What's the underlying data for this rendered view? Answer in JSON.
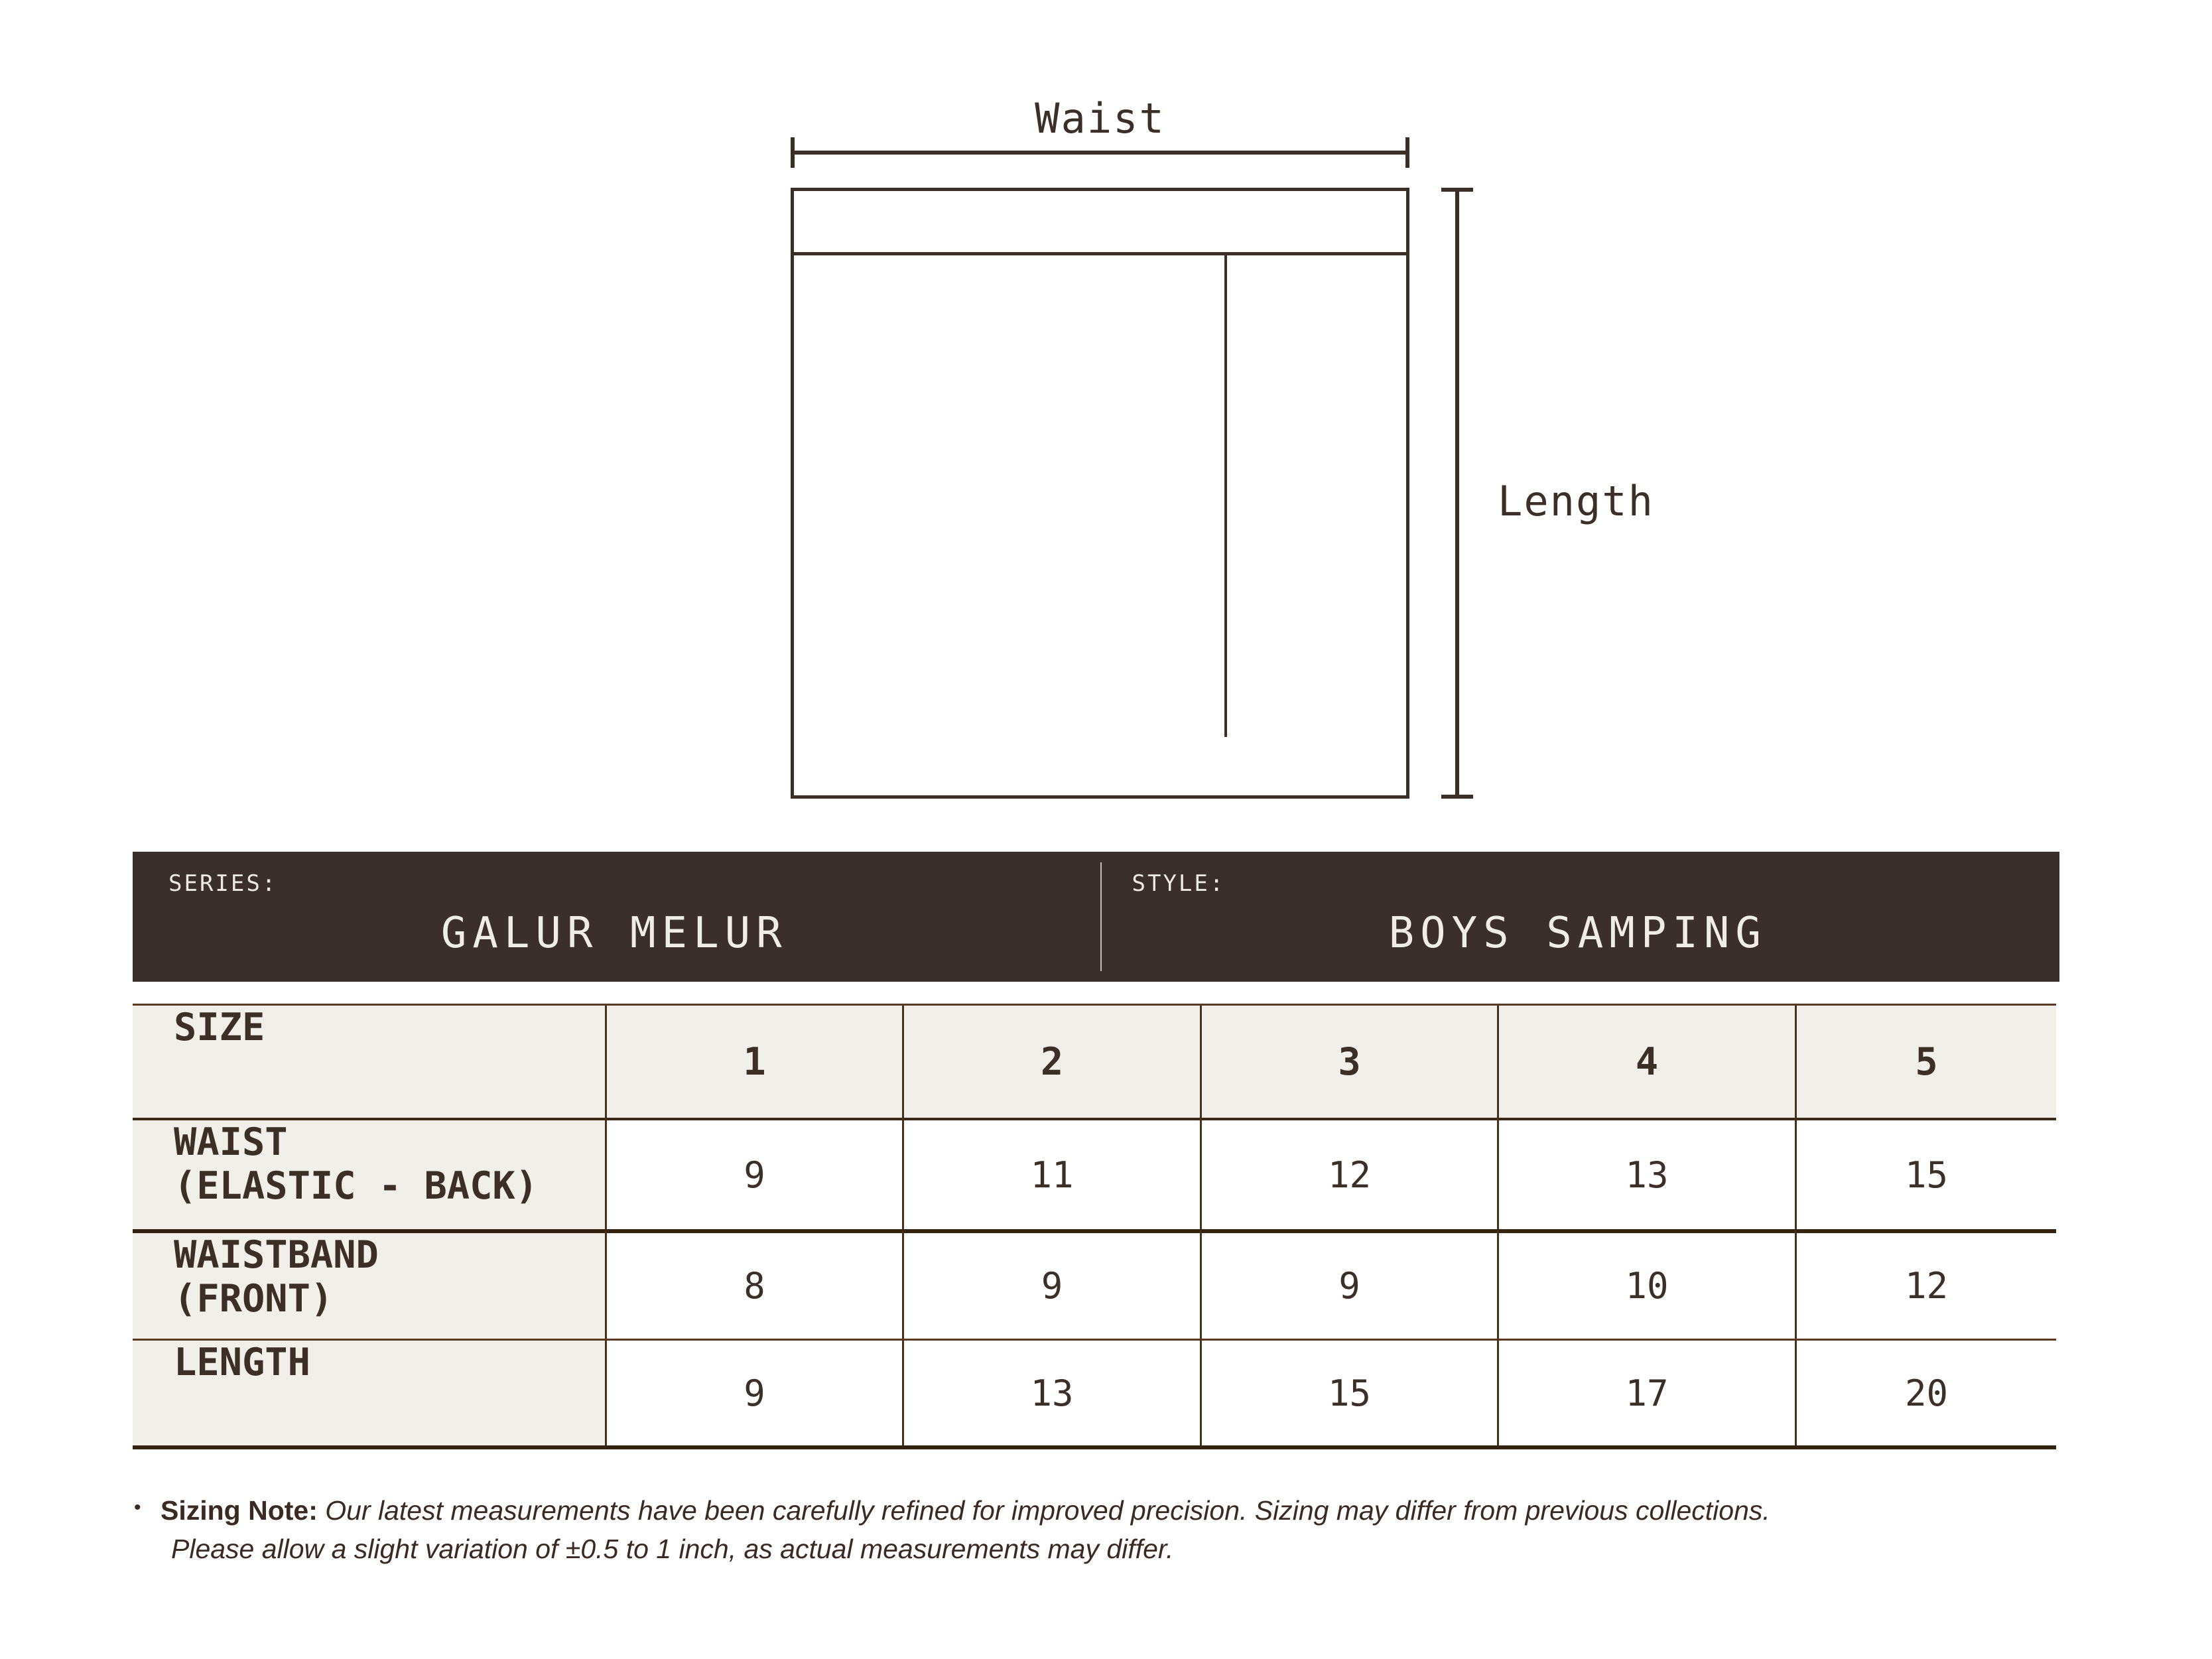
{
  "diagram": {
    "waist_label": "Waist",
    "length_label": "Length"
  },
  "banner": {
    "series_label": "SERIES:",
    "series_value": "GALUR MELUR",
    "style_label": "STYLE:",
    "style_value": "BOYS SAMPING"
  },
  "table": {
    "header": [
      "SIZE",
      "1",
      "2",
      "3",
      "4",
      "5"
    ],
    "rows": [
      {
        "label_line1": "WAIST",
        "label_line2": "(ELASTIC - BACK)",
        "values": [
          "9",
          "11",
          "12",
          "13",
          "15"
        ]
      },
      {
        "label_line1": "WAISTBAND",
        "label_line2": "(FRONT)",
        "values": [
          "8",
          "9",
          "9",
          "10",
          "12"
        ]
      },
      {
        "label_line1": "LENGTH",
        "label_line2": "",
        "values": [
          "9",
          "13",
          "15",
          "17",
          "20"
        ]
      }
    ]
  },
  "note": {
    "bullet": "•",
    "label": "Sizing Note:",
    "line1": " Our latest measurements have been carefully refined for improved precision. Sizing may differ from previous collections.",
    "line2": "Please allow a slight variation of ±0.5 to 1 inch, as actual measurements may differ."
  },
  "colors": {
    "banner_bg": "#3A2F2A",
    "banner_text": "#F0EDE7",
    "cell_beige": "#F1EFE9",
    "ink": "#3B2F28",
    "diagram_stroke": "#3A2E27",
    "border_thin": "#5A3A22",
    "border_thick": "#342310"
  }
}
